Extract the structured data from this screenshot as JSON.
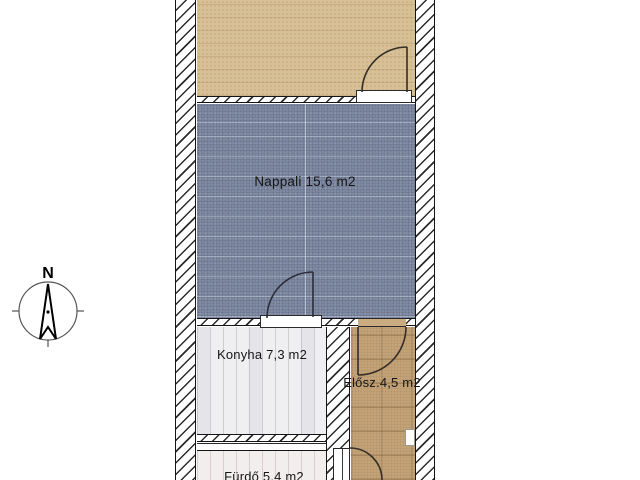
{
  "compass": {
    "north_label": "N"
  },
  "rooms": {
    "nappali": {
      "label": "Nappali 15,6 m2",
      "floor_color": "#7e89a2"
    },
    "konyha": {
      "label": "Konyha 7,3 m2",
      "floor_color": "#efeff2"
    },
    "eloszoba": {
      "label": "Elősz.4,5 m2",
      "floor_color": "#c4a379"
    },
    "furdo": {
      "label": "Fürdő 5,4 m2",
      "floor_color": "#f2eeee"
    },
    "top_room": {
      "floor_color": "#d7bf96"
    }
  },
  "walls": {
    "hatch_line_color": "#2b2b2b",
    "edge_color": "#151515"
  },
  "doors": {
    "arc_color": "#332e26"
  }
}
